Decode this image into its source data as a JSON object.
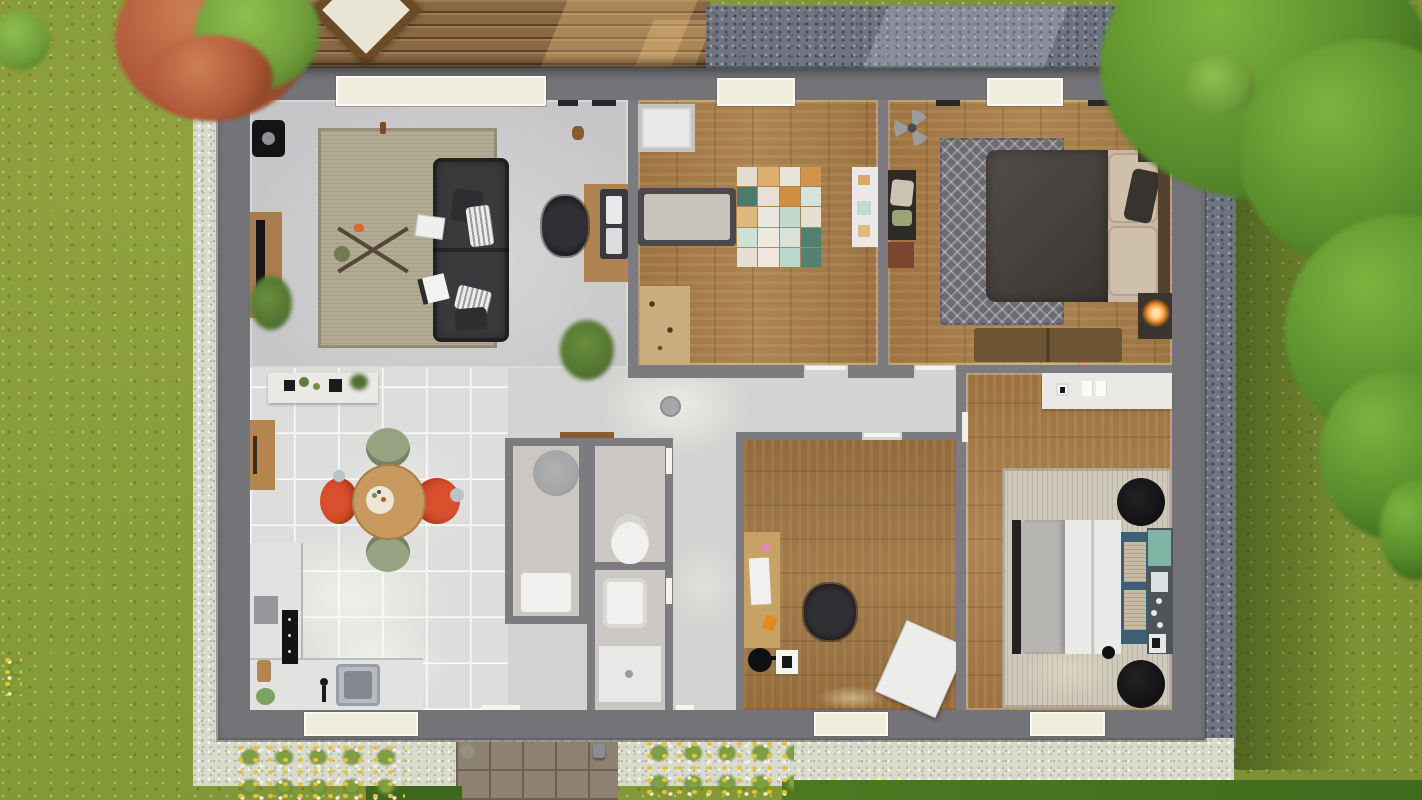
{
  "canvas": {
    "width": 1422,
    "height": 800
  },
  "scene": {
    "kind": "top-down-3d-floorplan-render",
    "rooms": [
      {
        "id": "living-room",
        "floor": "gray"
      },
      {
        "id": "kids-room",
        "floor": "wood"
      },
      {
        "id": "master-bedroom",
        "floor": "wood"
      },
      {
        "id": "kitchen-dining",
        "floor": "white-tile"
      },
      {
        "id": "shower-room",
        "floor": "gray"
      },
      {
        "id": "wc",
        "floor": "gray"
      },
      {
        "id": "bathroom",
        "floor": "gray"
      },
      {
        "id": "office",
        "floor": "wood"
      },
      {
        "id": "bedroom-2",
        "floor": "wood"
      },
      {
        "id": "hallway",
        "floor": "gray"
      }
    ],
    "exterior_features": [
      "lawn",
      "wood-deck",
      "deck-table",
      "blue-gravel-path",
      "white-gravel-border",
      "paver-path",
      "flower-beds",
      "green-trees-right",
      "red-tree-top-left",
      "hedges"
    ]
  },
  "colors": {
    "grass": "#7e9233",
    "treeGreen": "#578c2b",
    "treeGreenDark": "#3c671c",
    "treeGreenLight": "#7db43f",
    "treeRed": "#b05a3a",
    "treeRedDark": "#85401f",
    "leafGreen": "#6f9c3a",
    "deckWood": "#8a6843",
    "gravelBlue": "#6e7480",
    "gravelBlueDark": "#454a56",
    "gravelBlueLight": "#9ba1ad",
    "gravelWhite": "#d8dacc",
    "gravelWhiteDot": "#b7baa8",
    "pathTile": "#8d8270",
    "pathGap": "#6b6152",
    "flowerYellow": "#e4c33a",
    "flowerWhite": "#f2f0e2",
    "flowerGreen": "#7fa040",
    "wall": "#737378",
    "wallInner": "#7b7b80",
    "floorGray": "#c6c6c8",
    "floorHall": "#d3d3d1",
    "floorTile": "#dddddb",
    "woodFloor": "#a57c4a",
    "bathFloor": "#cbc8c4",
    "windowCream": "#f0eddd",
    "windowFrame": "#fafaf4",
    "rugBeige": "#b2aa93",
    "sofa": "#3a3a3d",
    "chairBlack": "#26262a",
    "rugChevron": "#6b6b71",
    "duvetDark": "#4a4440",
    "pillowBeige": "#c9b9a4",
    "headboard": "#55422e",
    "benchWood": "#6d5434",
    "nightstand": "#3a3531",
    "lampGlow": "#ffa040",
    "tableWood": "#c89a5f",
    "chairRed": "#d8502c",
    "chairGreen": "#97a283",
    "counter": "#e2e2e0",
    "sinkSteel": "#b7babf",
    "cooktop": "#131315",
    "fixtureWhite": "#f0f0ee",
    "showerGray": "#a4a5a7",
    "rugRibbed": "#cfc9bb",
    "duvetWhite": "#eaeae8",
    "blanketGray": "#b7b5b1",
    "benchBlue": "#3c5f74",
    "panelDark": "#4d545a",
    "teal": "#7fb3a4",
    "black": "#141416",
    "shelfWhite": "#ebe9e5",
    "wardrobe": "#d8d8d6",
    "matWood": "#c9ad7c",
    "deskWood": "#c8a166",
    "boardWhite": "#ececea",
    "plantGreen": "#4e7030",
    "plantGreenLight": "#6a8f3c",
    "potGreen": "#7ca263",
    "woodAccent": "#b5854e",
    "doorWood": "#8a5a32",
    "mattress": "#c9c4bb",
    "bedFrame": "#4a4a4c",
    "tvStand": "#a87c4c",
    "deckTable": "#e8e4d6",
    "deckTableRim": "#6b4a26"
  },
  "kids_rug": {
    "squares": [
      "#e3ddd0",
      "#dcae6f",
      "#e9e5da",
      "#d1944a",
      "#4e7a6b",
      "#e7e1d4",
      "#cf8f3f",
      "#d7e3da",
      "#ddb97e",
      "#e9e7e0",
      "#c3d9cd",
      "#e6dfd2",
      "#cfe0d6",
      "#efe9df",
      "#d8e2d8",
      "#53806e",
      "#e6e0d4",
      "#efe7db",
      "#bcd8cc",
      "#56806f"
    ]
  }
}
